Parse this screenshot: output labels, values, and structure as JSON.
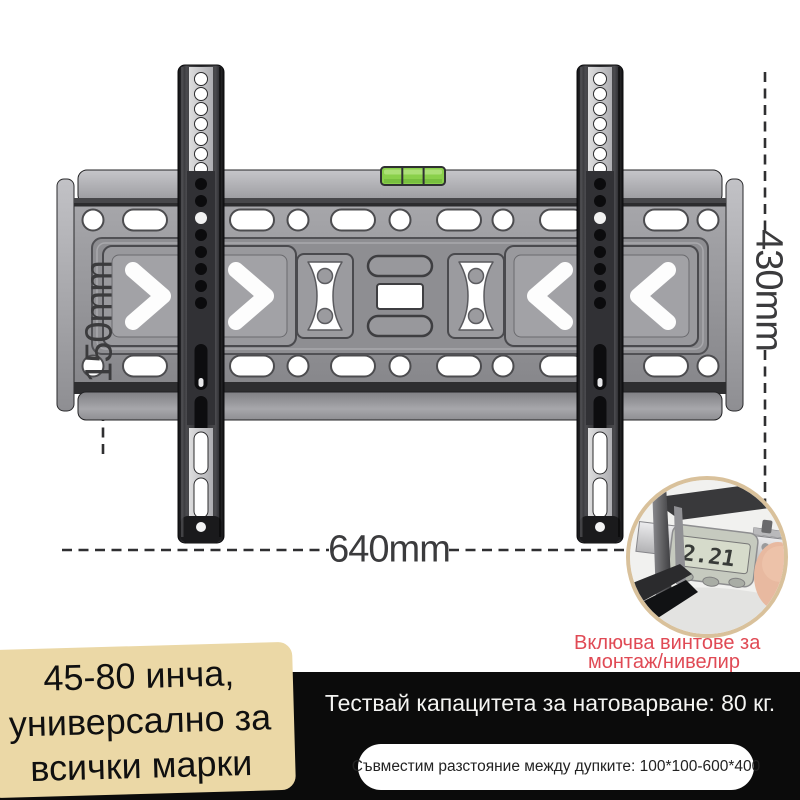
{
  "product": {
    "kind": "tv-wall-mount-bracket"
  },
  "dimensions": {
    "height_left": "150mm",
    "height_right": "430mm",
    "width_bottom": "640mm"
  },
  "inset": {
    "caliper_reading": "2.21",
    "caption_line1": "Включва винтове за",
    "caption_line2": "монтаж/нивелир"
  },
  "size_box": {
    "line1": "45-80 инча,",
    "line2": "универсално за",
    "line3": "всички марки"
  },
  "capacity_bar": {
    "text": "Тествай капацитета за натоварване: 80 кг."
  },
  "vesa_pill": {
    "text": "Съвместим разстояние между дупките: 100*100-600*400"
  },
  "colors": {
    "level_green": "#8ad04b",
    "annotation_red": "#e04a55",
    "badge_beige": "#ebd8a6",
    "bar_black": "#0b0b0b",
    "inset_border": "#d9c19b",
    "dash_gray": "#2f2f31",
    "background": "#ffffff"
  }
}
